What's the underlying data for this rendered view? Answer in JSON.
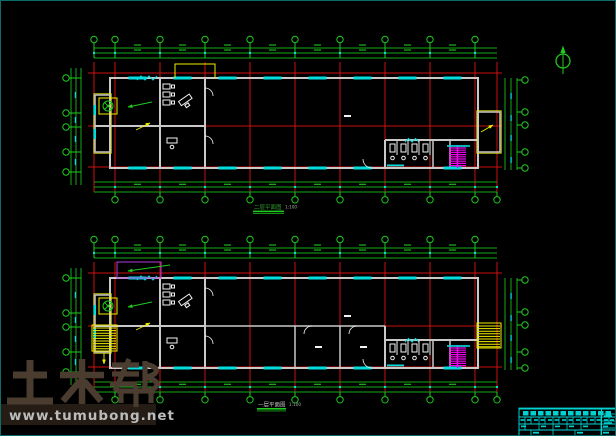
{
  "window": {
    "type": "cad-drawing-preview",
    "background": "#000000",
    "border_color": "#0e6b6b"
  },
  "colors": {
    "green": "#1ecb1e",
    "dimgreen": "#16a816",
    "red": "#cc1111",
    "cyan": "#00dede",
    "yellow": "#efef00",
    "magenta": "#ee00ee",
    "purple": "#b43ce0",
    "wall": "#c9c9c9",
    "white": "#f2f2f2",
    "titleblock": "#00d2d2",
    "watermark_text": "#4a3d30",
    "watermark_band": "#251d15",
    "watermark_url": "#bcbcbc",
    "label_green": "#2f9e2f",
    "label_gray": "#c4c4c4",
    "scale_gray": "#9fae9f"
  },
  "plans": {
    "upper": {
      "title": "二层平面图",
      "scale": "1:100"
    },
    "lower": {
      "title": "一层平面图",
      "scale": "1:100"
    }
  },
  "watermark": {
    "brand": "土木帮",
    "url": "www.tumubong.net"
  },
  "north_arrow": {
    "name": "north-arrow"
  }
}
